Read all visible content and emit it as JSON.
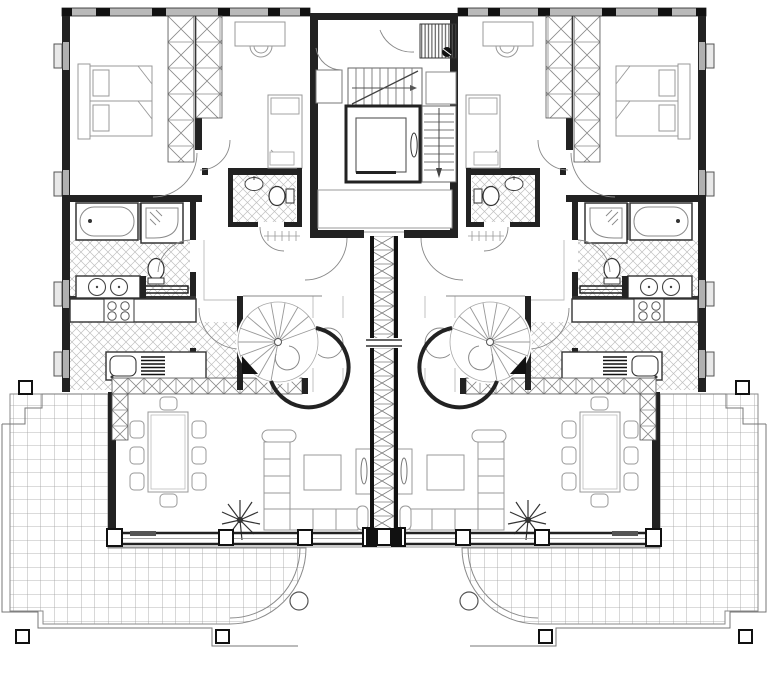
{
  "drawing": {
    "kind": "architectural floor plan",
    "description": "Mirrored two-unit residential upper floor plan with central stair core, elevator, spiral stairs, living rooms and tiled terraces",
    "visible_text": []
  },
  "colors": {
    "background": "#ffffff",
    "wall": "#1e1e1e",
    "medium_line": "#555555",
    "furniture_line": "#979797",
    "hatch_line": "#c0c0c0",
    "tile_line": "#9f9f9f",
    "window_fill": "#b9b9b9",
    "accent_black": "#111111"
  },
  "rooms": {
    "master_bedroom": "master bedroom",
    "second_bedroom": "second bedroom",
    "bathroom": "bathroom",
    "wc": "wc",
    "kitchen": "kitchen",
    "hall": "entrance hall",
    "living_room": "living room",
    "dining_area": "dining area",
    "stair_core": "stair core",
    "elevator": "elevator",
    "spiral_stair": "spiral staircase",
    "terrace": "terrace",
    "left_unit": "left apartment",
    "right_unit": "right apartment",
    "party_wall": "central party wall"
  },
  "fixtures": {
    "double_bed": "double bed",
    "single_bed": "single bed",
    "desk": "desk with chair",
    "wardrobe": "wardrobe",
    "bathtub": "bathtub",
    "shower": "shower",
    "toilet": "toilet",
    "washbasin": "washbasin",
    "double_washbasin": "double washbasin vanity",
    "hob": "four-burner cooktop",
    "sink": "kitchen sink with drainer",
    "dining_table": "dining table with eight chairs",
    "sofa": "corner sofa",
    "coffee_table": "coffee table",
    "tv_unit": "tv unit",
    "plant": "plant",
    "vent_shaft": "ventilation shaft",
    "stairs": "main staircase",
    "terrace_posts": "terrace posts",
    "step_light": "terrace step light"
  }
}
